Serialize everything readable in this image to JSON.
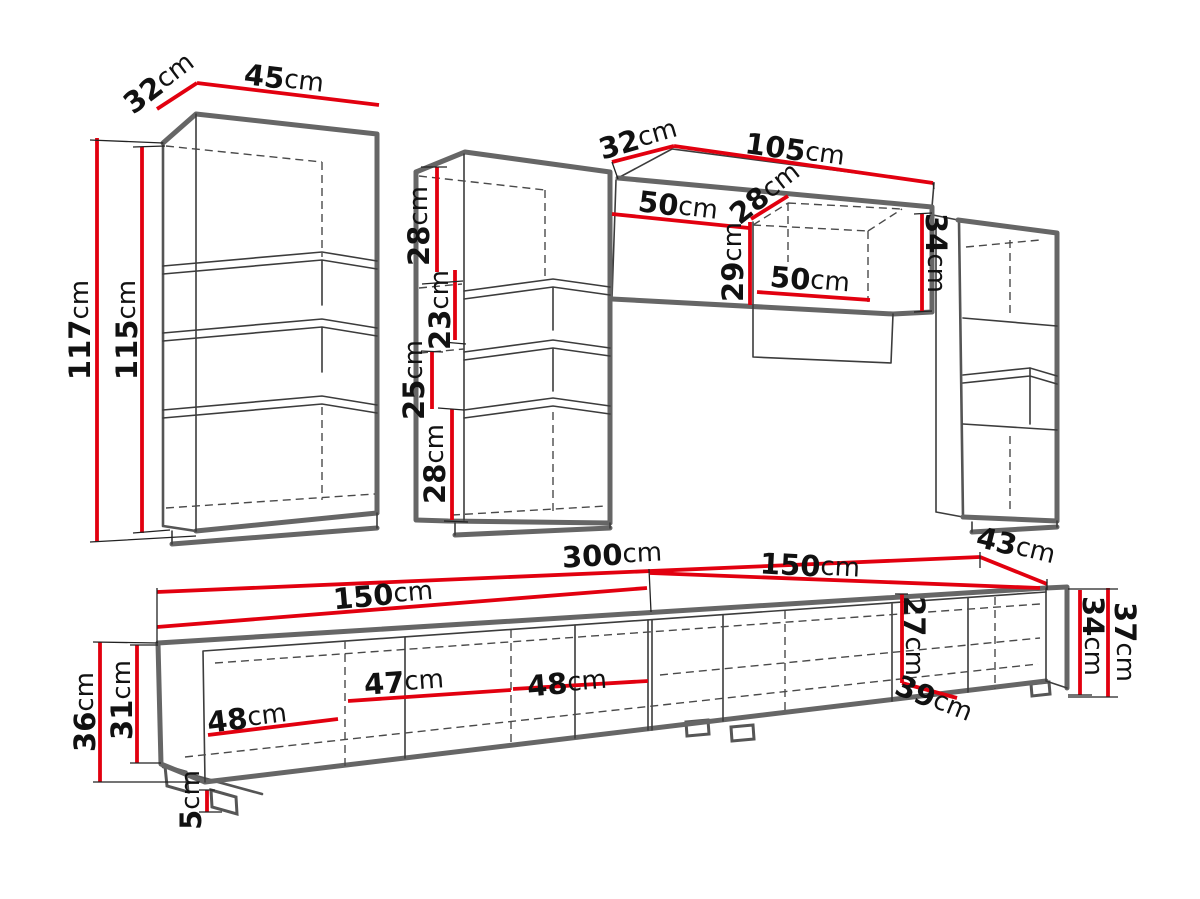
{
  "page": {
    "background": "#ffffff"
  },
  "colors": {
    "dimension_line": "#e2000f",
    "outline": "#666666",
    "detail_line": "#3c3c3c",
    "label_text": "#111111"
  },
  "unit": "cm",
  "cabinets": {
    "left_tall_cabinet": {
      "depth": {
        "num": "32",
        "unit": "cm"
      },
      "width": {
        "num": "45",
        "unit": "cm"
      },
      "height_outer": {
        "num": "117",
        "unit": "cm"
      },
      "height_inner": {
        "num": "115",
        "unit": "cm"
      }
    },
    "middle_tall_cabinet": {
      "top_section_height": {
        "num": "28",
        "unit": "cm"
      },
      "upper_shelf_height": {
        "num": "23",
        "unit": "cm"
      },
      "lower_shelf_height": {
        "num": "25",
        "unit": "cm"
      },
      "bottom_section_height": {
        "num": "28",
        "unit": "cm"
      }
    },
    "wall_cabinet": {
      "depth": {
        "num": "32",
        "unit": "cm"
      },
      "width": {
        "num": "105",
        "unit": "cm"
      },
      "left_compartment_width": {
        "num": "50",
        "unit": "cm"
      },
      "compartment_depth": {
        "num": "28",
        "unit": "cm"
      },
      "compartment_height": {
        "num": "29",
        "unit": "cm"
      },
      "right_compartment_width": {
        "num": "50",
        "unit": "cm"
      },
      "height": {
        "num": "34",
        "unit": "cm"
      }
    },
    "tv_stand": {
      "total_width": {
        "num": "300",
        "unit": "cm"
      },
      "left_module_width": {
        "num": "150",
        "unit": "cm"
      },
      "right_module_width": {
        "num": "150",
        "unit": "cm"
      },
      "depth": {
        "num": "43",
        "unit": "cm"
      },
      "door1_width": {
        "num": "48",
        "unit": "cm"
      },
      "door2_width": {
        "num": "47",
        "unit": "cm"
      },
      "door3_width": {
        "num": "48",
        "unit": "cm"
      },
      "inner_height": {
        "num": "27",
        "unit": "cm"
      },
      "inner_depth": {
        "num": "39",
        "unit": "cm"
      },
      "right_height_inner": {
        "num": "34",
        "unit": "cm"
      },
      "right_height_outer": {
        "num": "37",
        "unit": "cm"
      },
      "left_height_outer": {
        "num": "36",
        "unit": "cm"
      },
      "left_height_inner": {
        "num": "31",
        "unit": "cm"
      },
      "leg_height": {
        "num": "5",
        "unit": "cm"
      }
    }
  }
}
